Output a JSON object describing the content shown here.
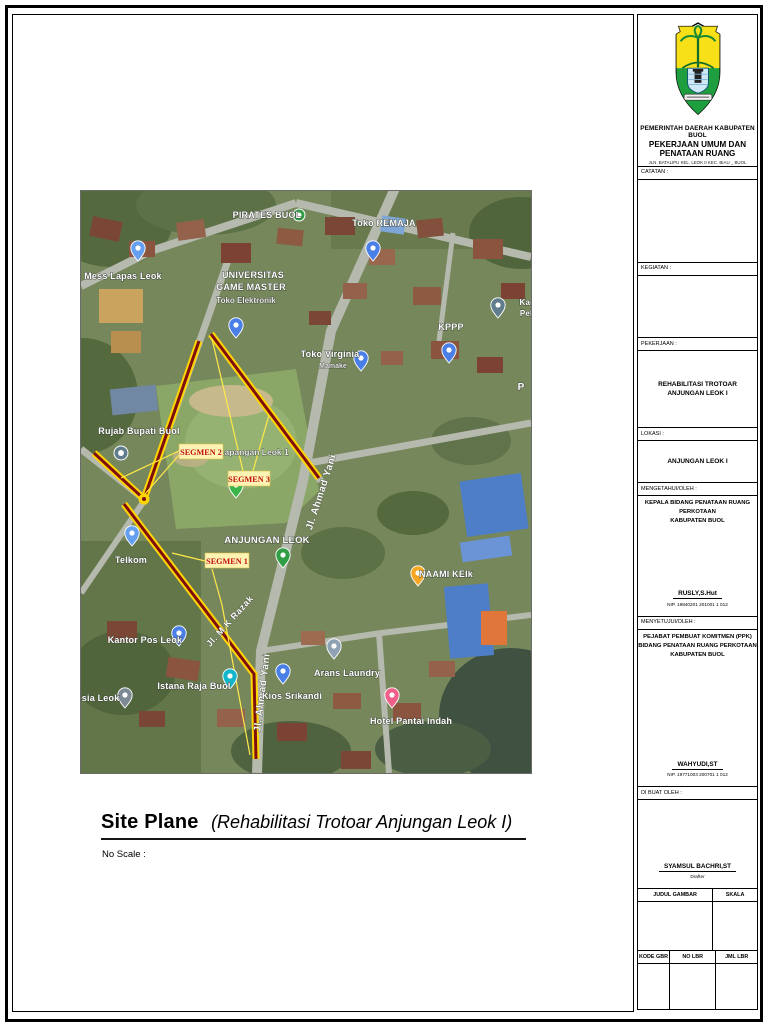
{
  "caption": {
    "title": "Site Plane",
    "subtitle": "(Rehabilitasi Trotoar Anjungan Leok I)",
    "scale_note": "No Scale :"
  },
  "title_block": {
    "agency_line1": "PEMERINTAH DAERAH KABUPATEN BUOL",
    "agency_line2": "PEKERJAAN UMUM DAN PENATAAN RUANG",
    "agency_address": "JLN. BATALIPU KEL. LEOK II KEC. BIAU _ BUOL",
    "catatan_label": "CATATAN :",
    "kegiatan_label": "KEGIATAN :",
    "pekerjaan_label": "PEKERJAAN :",
    "pekerjaan_value": "REHABILITASI TROTOAR ANJUNGAN LEOK I",
    "lokasi_label": "LOKASI :",
    "lokasi_value": "ANJUNGAN LEOK I",
    "mengetahui_label": "MENGETAHUI/OLEH :",
    "mengetahui_role_line1": "KEPALA BIDANG PENATAAN RUANG PERKOTAAN",
    "mengetahui_role_line2": "KABUPATEN BUOL",
    "mengetahui_name": "RUSLY,S.Hut",
    "mengetahui_nip": "NIP. 19840201 201001 1 012",
    "menyetujui_label": "MENYETUJUI/OLEH :",
    "menyetujui_role_line1": "PEJABAT PEMBUAT KOMITMEN (PPK)",
    "menyetujui_role_line2": "BIDANG PENATAAN RUANG PERKOTAAN",
    "menyetujui_role_line3": "KABUPATEN BUOL",
    "dibuat_label": "DI BUAT OLEH :",
    "menyetujui_name": "WAHYUDI,ST",
    "menyetujui_nip": "NIP. 19771003 200701 1 012",
    "dibuat_name": "SYAMSUL BACHRI,ST",
    "dibuat_role": "Drafter",
    "table": {
      "judul_gambar": "JUDUL GAMBAR",
      "skala": "SKALA",
      "kode_gbr": "KODE GBR",
      "no_lbr": "NO LBR",
      "jml_lbr": "JML LBR"
    }
  },
  "map": {
    "accent_colors": {
      "segment_yellow": "#ffd500",
      "segment_red": "#7e0f0f",
      "segment_label_red": "#c40f0f",
      "segment_label_bg": "#fdf3b3"
    },
    "segment_labels": [
      {
        "id": "segmen-1",
        "text": "SEGMEN 1",
        "x": 124,
        "y": 362,
        "w": 44,
        "h": 15
      },
      {
        "id": "segmen-2",
        "text": "SEGMEN 2",
        "x": 98,
        "y": 253,
        "w": 44,
        "h": 15
      },
      {
        "id": "segmen-3",
        "text": "SEGMEN 3",
        "x": 147,
        "y": 280,
        "w": 42,
        "h": 15
      }
    ],
    "street_labels": [
      {
        "id": "jl-ahmad-yani-upper",
        "text": "Jl. Ahmad Yani",
        "x": 243,
        "y": 302,
        "rotate": -72,
        "size": 10
      },
      {
        "id": "jl-ahmad-yani-lower",
        "text": "Jl. Ahmad Yani",
        "x": 184,
        "y": 502,
        "rotate": -83,
        "size": 10
      },
      {
        "id": "jl-m-k-razak",
        "text": "Jl. M K Razak",
        "x": 151,
        "y": 432,
        "rotate": -48,
        "size": 9
      }
    ],
    "place_labels": [
      {
        "id": "pirates-buol",
        "text": "PIRATES BUOL",
        "x": 186,
        "y": 27,
        "size": 9
      },
      {
        "id": "toko-remaja",
        "text": "Toko REMAJA",
        "x": 303,
        "y": 35,
        "size": 9
      },
      {
        "id": "mess-lapas-leok",
        "text": "Mess Lapas Leok",
        "x": 42,
        "y": 88,
        "size": 9
      },
      {
        "id": "universitas",
        "text": "UNIVERSITAS",
        "x": 172,
        "y": 87,
        "size": 9
      },
      {
        "id": "game-master",
        "text": "GAME MASTER",
        "x": 170,
        "y": 99,
        "size": 9
      },
      {
        "id": "toko-elektronik",
        "text": "Toko Elektronik",
        "x": 165,
        "y": 112,
        "size": 8,
        "cls": "gl2"
      },
      {
        "id": "kantor-pelab-1",
        "text": "Kantor",
        "x": 452,
        "y": 114,
        "size": 8
      },
      {
        "id": "kantor-pelab-2",
        "text": "Pelab",
        "x": 450,
        "y": 125,
        "size": 8
      },
      {
        "id": "kppp",
        "text": "KPPP",
        "x": 370,
        "y": 139,
        "size": 9
      },
      {
        "id": "toko-virginia",
        "text": "Toko Virginia",
        "x": 249,
        "y": 166,
        "size": 9
      },
      {
        "id": "toko-virginia-sub",
        "text": "Mamake",
        "x": 252,
        "y": 177,
        "size": 7,
        "cls": "gl2"
      },
      {
        "id": "p-partial",
        "text": "P",
        "x": 440,
        "y": 199,
        "size": 10
      },
      {
        "id": "rujab-bupati-buol",
        "text": "Rujab Bupati Buol",
        "x": 58,
        "y": 243,
        "size": 9
      },
      {
        "id": "lapangan-leok-1",
        "text": "Lapangan Leok 1",
        "x": 173,
        "y": 264,
        "size": 8.5,
        "cls": "gl2"
      },
      {
        "id": "telkom",
        "text": "Telkom",
        "x": 50,
        "y": 372,
        "size": 9
      },
      {
        "id": "anjungan-leok",
        "text": "ANJUNGAN LEOK",
        "x": 186,
        "y": 352,
        "size": 9.5,
        "ls": 1.4
      },
      {
        "id": "naami-keik",
        "text": "NAAMI KEIk",
        "x": 365,
        "y": 386,
        "size": 9
      },
      {
        "id": "kantor-pos-leok",
        "text": "Kantor Pos Leok",
        "x": 64,
        "y": 452,
        "size": 9
      },
      {
        "id": "arans-laundry",
        "text": "Arans Laundry",
        "x": 266,
        "y": 485,
        "size": 9
      },
      {
        "id": "esia-leok",
        "text": "esia Leok",
        "x": 17,
        "y": 510,
        "size": 9
      },
      {
        "id": "istana-raja-buol",
        "text": "Istana Raja Buol",
        "x": 113,
        "y": 498,
        "size": 9
      },
      {
        "id": "kios-srikandi",
        "text": "Kios Srikandi",
        "x": 211,
        "y": 508,
        "size": 9
      },
      {
        "id": "hotel-pantai-indah",
        "text": "Hotel Pantai Indah",
        "x": 330,
        "y": 533,
        "size": 9
      }
    ],
    "markers": [
      {
        "id": "pirates-buol",
        "kind": "circle",
        "color": "#2f9e44",
        "x": 218,
        "y": 24,
        "r": 6
      },
      {
        "id": "toko-remaja",
        "kind": "pin",
        "color": "#4a7fe8",
        "x": 292,
        "y": 70
      },
      {
        "id": "mess-lapas-leok",
        "kind": "pin",
        "color": "#64a0ef",
        "x": 57,
        "y": 70
      },
      {
        "id": "toko-elektronik",
        "kind": "pin",
        "color": "#4a7fe8",
        "x": 155,
        "y": 147
      },
      {
        "id": "kantor-pelab",
        "kind": "pin",
        "color": "#5f7d8c",
        "x": 417,
        "y": 127
      },
      {
        "id": "kppp",
        "kind": "pin",
        "color": "#4a7fe8",
        "x": 368,
        "y": 172
      },
      {
        "id": "toko-virginia",
        "kind": "pin",
        "color": "#4a7fe8",
        "x": 280,
        "y": 180
      },
      {
        "id": "rujab-bupati-buol",
        "kind": "circle",
        "color": "#5f7d8c",
        "x": 40,
        "y": 262,
        "r": 7
      },
      {
        "id": "segmen-3-pin",
        "kind": "pin",
        "color": "#3ab54a",
        "x": 155,
        "y": 307
      },
      {
        "id": "telkom",
        "kind": "pin",
        "color": "#64a0ef",
        "x": 51,
        "y": 355
      },
      {
        "id": "anjungan-leok",
        "kind": "pin",
        "color": "#2f9e44",
        "x": 202,
        "y": 377
      },
      {
        "id": "naami-keik",
        "kind": "pin",
        "color": "#f5a623",
        "x": 337,
        "y": 395
      },
      {
        "id": "kantor-pos-leok",
        "kind": "pin",
        "color": "#4a7fe8",
        "x": 98,
        "y": 455
      },
      {
        "id": "arans-laundry",
        "kind": "pin",
        "color": "#8fa2b3",
        "x": 253,
        "y": 468
      },
      {
        "id": "istana-raja-buol",
        "kind": "pin",
        "color": "#12b5cb",
        "x": 149,
        "y": 498
      },
      {
        "id": "kios-srikandi",
        "kind": "pin",
        "color": "#4a7fe8",
        "x": 202,
        "y": 493
      },
      {
        "id": "gereja-esia-leok",
        "kind": "pin",
        "color": "#7d8a93",
        "x": 44,
        "y": 517
      },
      {
        "id": "hotel-pantai-indah",
        "kind": "pin",
        "color": "#ef5f8a",
        "x": 311,
        "y": 517
      }
    ]
  }
}
